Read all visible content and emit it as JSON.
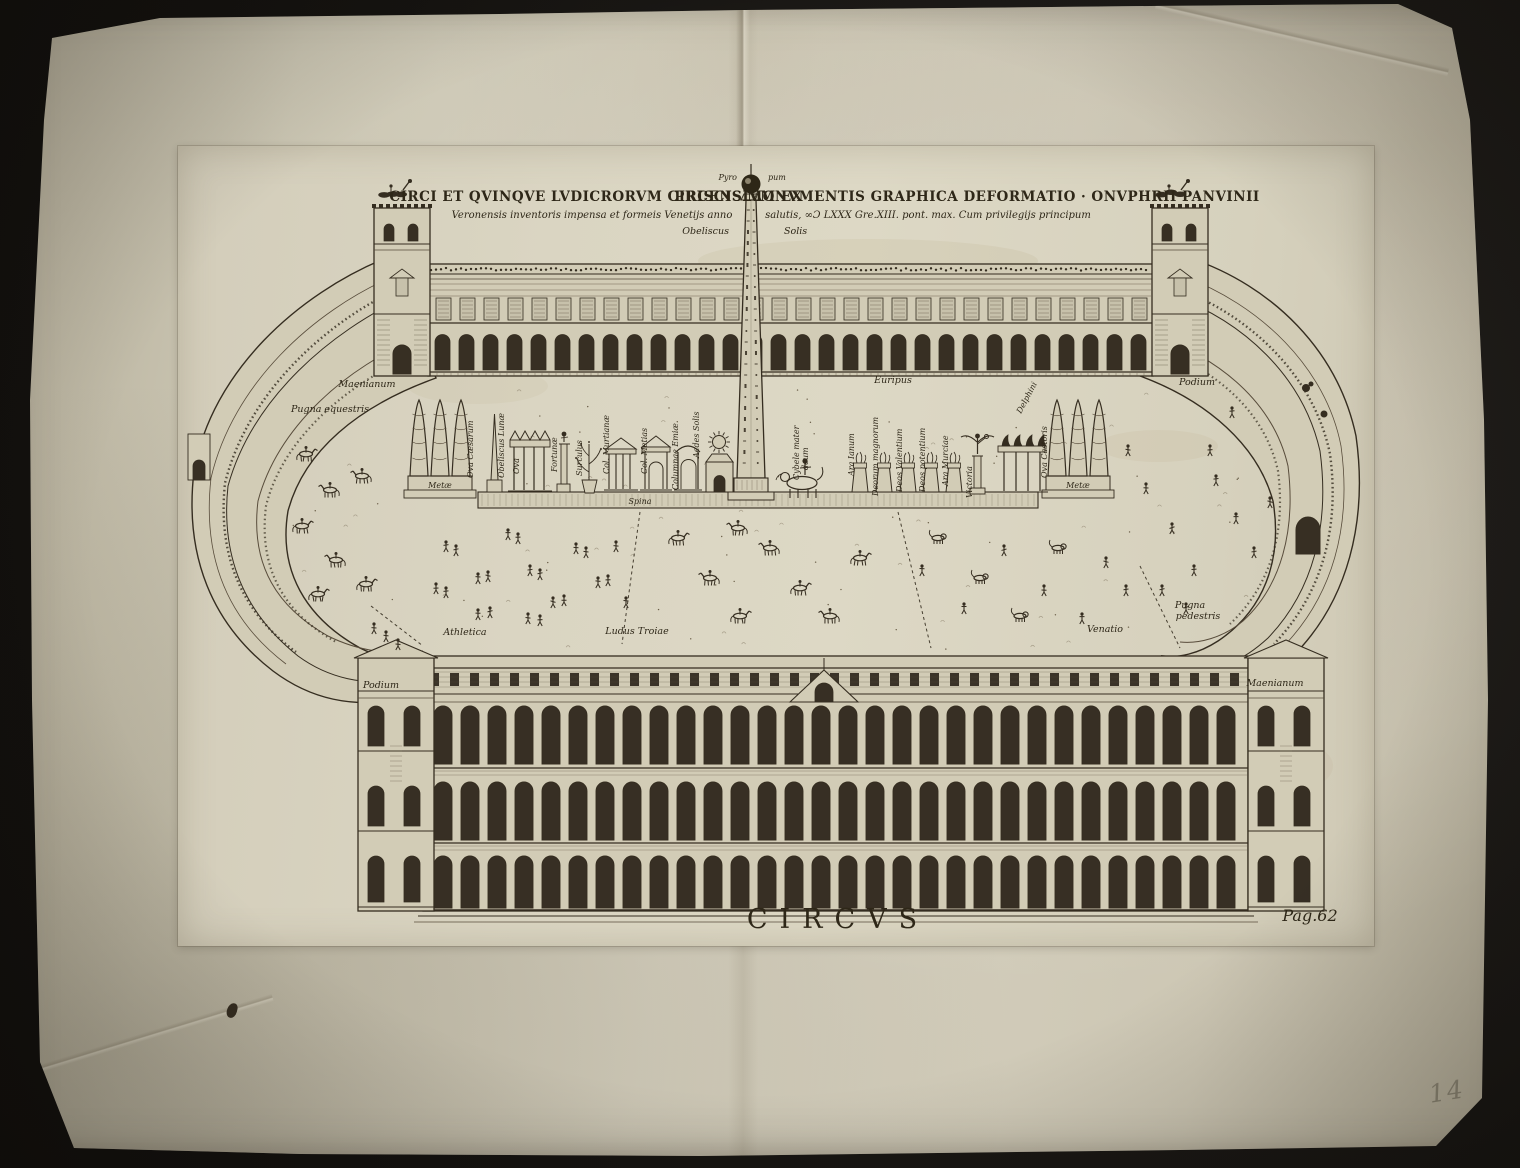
{
  "artwork": {
    "caption": "CIRCVS",
    "page_ref": "Pag.62",
    "handwritten_number": "14",
    "title": {
      "line1_left": "CIRCI ET QVINQVE LVDICRORVM CIRCENSIVM EX",
      "line1_right": "PRISCIS MONVMENTIS GRAPHICA DEFORMATIO · ONVPHRII PANVINII",
      "line2_left": "Veronensis inventoris impensa et formeis Venetijs anno",
      "line2_right": "salutis, ∞Ɔ LXXX Gre.XIII. pont. max. Cum privilegijs principum"
    },
    "obelisk": {
      "top_left": "Pyro",
      "top_right": "pum",
      "name_left": "Obeliscus",
      "name_right": "Solis"
    }
  },
  "labels": {
    "maenianum_top": "Maenianum",
    "pugna_equestris": "Pugna equestris",
    "podium_right": "Podium",
    "euripus": "Euripus",
    "ova_caesarum": "Ova Cæsarum",
    "obeliscus_lunae": "Obeliscus Lunæ",
    "ova": "Ova",
    "fortunae": "Fortunæ",
    "surculus": "Surculus",
    "col_murtianae": "Col. Murtianæ",
    "col_metias": "Col. Metias",
    "columnae_emiae": "Columnae Emiæ",
    "aedes_solis": "Aedes Solis",
    "spina": "Spina",
    "meta_left": "Metæ",
    "meta_right": "Metæ",
    "cybele_1": "Cybele mater",
    "cybele_2": "deum",
    "ara_ianum": "Ara Ianum",
    "deorum_magnorum": "Deorum magnorum",
    "deos_valentium": "Deos Valentium",
    "deos_potentium": "Deos potentium",
    "ara_murciae": "Ara Murciae",
    "victoria": "Victoria",
    "delphini": "Delphini",
    "ova_castoris": "Ova Castoris",
    "athletica": "Athletica",
    "ludus_troiae": "Ludus Troiae",
    "venatio": "Venatio",
    "pugna_pedestris_1": "Pugna",
    "pugna_pedestris_2": "pedestris",
    "podium_left": "Podium",
    "maenianum_bottom": "Maenianum"
  },
  "colors": {
    "background": "#151310",
    "paper": "#cfc9b6",
    "plate_paper": "#d9d3c0",
    "ink": "#332c20",
    "pencil": "#8b8573"
  }
}
